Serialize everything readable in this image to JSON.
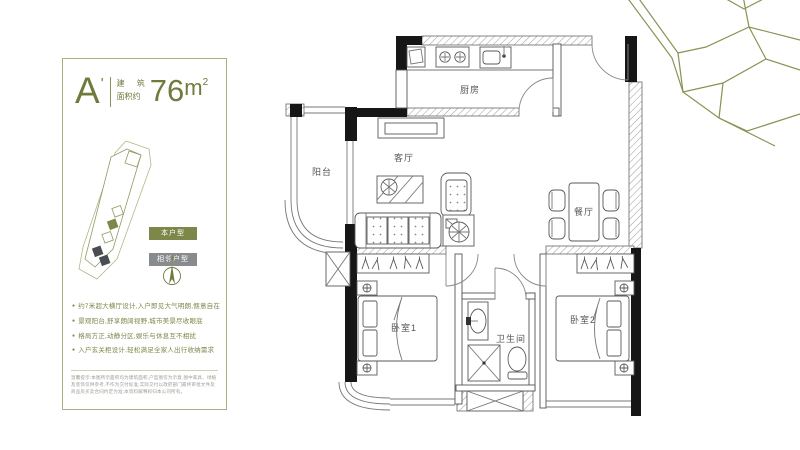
{
  "colors": {
    "accent_olive": "#6f7a3c",
    "badge_olive": "#7d8749",
    "badge_gray": "#898c8f",
    "wall_black": "#161616",
    "panel_border": "#abb083"
  },
  "panel": {
    "unit_letter": "A",
    "unit_prime": "'",
    "area_label_line1": "建 筑",
    "area_label_line2": "面积约",
    "area_number": "76",
    "area_unit": "m",
    "area_unit_sup": "2",
    "legend": {
      "self_label": "本户型",
      "adjacent_label": "相邻户型"
    },
    "compass_north": "北",
    "bullet_glyph": "●",
    "features": [
      "约7米超大横厅设计,入户即见大气明朗,惬意自在",
      "景观阳台,舒享朗阔视野,城市美景尽收眼底",
      "格局方正,动静分区,娱乐与休息互不相扰",
      "入户玄关柜设计,轻松满足全家人出行收纳需求"
    ],
    "disclaimer": "温馨提示:本图所示面积均为建筑面积,户型图仅为示意,图中家具、绿植及装饰仅供参考,不作为交付标准;实际交付以政府部门最终审批文件及商品房买卖合同约定为准;本资料解释权归本公司所有。"
  },
  "floorplan": {
    "rooms": {
      "kitchen": "厨房",
      "living": "客厅",
      "balcony": "阳台",
      "dining": "餐厅",
      "bedroom1": "卧室1",
      "bathroom": "卫生间",
      "bedroom2": "卧室2"
    },
    "icons": [
      "stove-icon",
      "sink-icon",
      "fridge-icon",
      "tv-cabinet-icon",
      "sofa-icon",
      "coffee-table-icon",
      "armchair-icon",
      "plant-icon",
      "dining-table-icon",
      "chair-icon",
      "bed-icon",
      "nightstand-icon",
      "wardrobe-icon",
      "washbasin-icon",
      "shower-icon",
      "toilet-icon",
      "shaft-icon",
      "door-arc-icon",
      "compass-icon"
    ]
  }
}
